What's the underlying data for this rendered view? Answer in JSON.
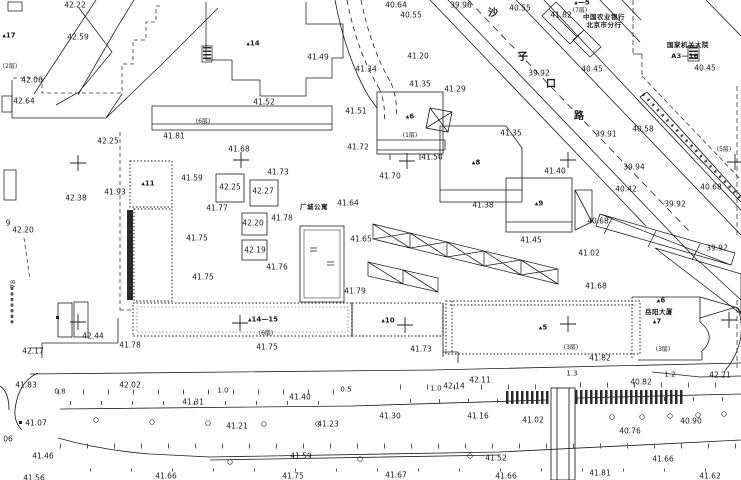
{
  "map_meta": {
    "type": "cadastral-site-plan",
    "background_color": "#ffffff",
    "line_color": "#1c1c1c",
    "dashed_color": "#444444"
  },
  "annotations": [
    {
      "x": 75,
      "y": 5,
      "t": "42.22",
      "k": "e"
    },
    {
      "x": 78,
      "y": 37,
      "t": "42.59",
      "k": "e"
    },
    {
      "x": 32,
      "y": 80,
      "t": "42.06",
      "k": "e"
    },
    {
      "x": 24,
      "y": 101,
      "t": "42.64",
      "k": "e"
    },
    {
      "x": 76,
      "y": 198,
      "t": "42.38",
      "k": "e"
    },
    {
      "x": 23,
      "y": 230,
      "t": "42.20",
      "k": "e"
    },
    {
      "x": 8,
      "y": 223,
      "t": "9",
      "k": "e"
    },
    {
      "x": 108,
      "y": 141,
      "t": "42.25",
      "k": "e"
    },
    {
      "x": 115,
      "y": 192,
      "t": "41.93",
      "k": "e"
    },
    {
      "x": 192,
      "y": 178,
      "t": "41.59",
      "k": "e"
    },
    {
      "x": 217,
      "y": 208,
      "t": "41.77",
      "k": "e"
    },
    {
      "x": 197,
      "y": 238,
      "t": "41.75",
      "k": "e"
    },
    {
      "x": 203,
      "y": 277,
      "t": "41.75",
      "k": "e"
    },
    {
      "x": 174,
      "y": 136,
      "t": "41.81",
      "k": "e"
    },
    {
      "x": 239,
      "y": 149,
      "t": "41.68",
      "k": "e"
    },
    {
      "x": 278,
      "y": 172,
      "t": "41.73",
      "k": "e"
    },
    {
      "x": 230,
      "y": 187,
      "t": "42.25",
      "k": "e"
    },
    {
      "x": 263,
      "y": 191,
      "t": "42.27",
      "k": "e"
    },
    {
      "x": 253,
      "y": 223,
      "t": "42.20",
      "k": "e"
    },
    {
      "x": 282,
      "y": 218,
      "t": "41.78",
      "k": "e"
    },
    {
      "x": 255,
      "y": 250,
      "t": "42.19",
      "k": "e"
    },
    {
      "x": 277,
      "y": 267,
      "t": "41.76",
      "k": "e"
    },
    {
      "x": 348,
      "y": 203,
      "t": "41.64",
      "k": "e"
    },
    {
      "x": 355,
      "y": 291,
      "t": "41.79",
      "k": "e"
    },
    {
      "x": 361,
      "y": 239,
      "t": "41.65",
      "k": "e"
    },
    {
      "x": 390,
      "y": 176,
      "t": "41.70",
      "k": "e"
    },
    {
      "x": 356,
      "y": 111,
      "t": "41.51",
      "k": "e"
    },
    {
      "x": 264,
      "y": 102,
      "t": "41.52",
      "k": "e"
    },
    {
      "x": 318,
      "y": 57,
      "t": "41.49",
      "k": "e"
    },
    {
      "x": 366,
      "y": 69,
      "t": "41.34",
      "k": "e"
    },
    {
      "x": 358,
      "y": 147,
      "t": "41.72",
      "k": "e"
    },
    {
      "x": 418,
      "y": 56,
      "t": "41.20",
      "k": "e"
    },
    {
      "x": 420,
      "y": 84,
      "t": "41.35",
      "k": "e"
    },
    {
      "x": 455,
      "y": 89,
      "t": "41.29",
      "k": "e"
    },
    {
      "x": 432,
      "y": 157,
      "t": "41.50",
      "k": "e"
    },
    {
      "x": 483,
      "y": 205,
      "t": "41.38",
      "k": "e"
    },
    {
      "x": 396,
      "y": 5,
      "t": "40.64",
      "k": "e"
    },
    {
      "x": 411,
      "y": 15,
      "t": "40.55",
      "k": "e"
    },
    {
      "x": 461,
      "y": 5,
      "t": "39.96",
      "k": "e"
    },
    {
      "x": 520,
      "y": 8,
      "t": "40.55",
      "k": "e"
    },
    {
      "x": 561,
      "y": 15,
      "t": "41.82",
      "k": "e"
    },
    {
      "x": 539,
      "y": 73,
      "t": "39.92",
      "k": "e"
    },
    {
      "x": 592,
      "y": 69,
      "t": "40.45",
      "k": "e"
    },
    {
      "x": 705,
      "y": 68,
      "t": "40.45",
      "k": "e"
    },
    {
      "x": 643,
      "y": 129,
      "t": "40.58",
      "k": "e"
    },
    {
      "x": 606,
      "y": 134,
      "t": "39.91",
      "k": "e"
    },
    {
      "x": 634,
      "y": 167,
      "t": "39.94",
      "k": "e"
    },
    {
      "x": 555,
      "y": 171,
      "t": "41.40",
      "k": "e"
    },
    {
      "x": 511,
      "y": 133,
      "t": "41.35",
      "k": "e"
    },
    {
      "x": 626,
      "y": 189,
      "t": "40.42",
      "k": "e"
    },
    {
      "x": 598,
      "y": 221,
      "t": "40.68",
      "k": "e"
    },
    {
      "x": 711,
      "y": 187,
      "t": "40.68",
      "k": "e"
    },
    {
      "x": 675,
      "y": 204,
      "t": "39.92",
      "k": "e"
    },
    {
      "x": 717,
      "y": 248,
      "t": "39.92",
      "k": "e"
    },
    {
      "x": 531,
      "y": 240,
      "t": "41.45",
      "k": "e"
    },
    {
      "x": 589,
      "y": 253,
      "t": "41.02",
      "k": "e"
    },
    {
      "x": 596,
      "y": 286,
      "t": "41.68",
      "k": "e"
    },
    {
      "x": 93,
      "y": 336,
      "t": "42.44",
      "k": "e"
    },
    {
      "x": 33,
      "y": 351,
      "t": "42.17",
      "k": "e"
    },
    {
      "x": 130,
      "y": 345,
      "t": "41.78",
      "k": "e"
    },
    {
      "x": 26,
      "y": 385,
      "t": "41.83",
      "k": "e"
    },
    {
      "x": 130,
      "y": 385,
      "t": "42.02",
      "k": "e"
    },
    {
      "x": 193,
      "y": 402,
      "t": "41.31",
      "k": "e"
    },
    {
      "x": 36,
      "y": 423,
      "t": "41.07",
      "k": "e"
    },
    {
      "x": 237,
      "y": 426,
      "t": "41.21",
      "k": "e"
    },
    {
      "x": 43,
      "y": 456,
      "t": "41.46",
      "k": "e"
    },
    {
      "x": 34,
      "y": 478,
      "t": "41.56",
      "k": "e"
    },
    {
      "x": 166,
      "y": 476,
      "t": "41.66",
      "k": "e"
    },
    {
      "x": 8,
      "y": 439,
      "t": "06",
      "k": "e"
    },
    {
      "x": 267,
      "y": 347,
      "t": "41.75",
      "k": "e"
    },
    {
      "x": 421,
      "y": 349,
      "t": "41.73",
      "k": "e"
    },
    {
      "x": 300,
      "y": 397,
      "t": "41.40",
      "k": "e"
    },
    {
      "x": 454,
      "y": 386,
      "t": "42.14",
      "k": "e"
    },
    {
      "x": 480,
      "y": 380,
      "t": "42.11",
      "k": "e"
    },
    {
      "x": 390,
      "y": 416,
      "t": "41.30",
      "k": "e"
    },
    {
      "x": 478,
      "y": 416,
      "t": "41.16",
      "k": "e"
    },
    {
      "x": 328,
      "y": 424,
      "t": "41.23",
      "k": "e"
    },
    {
      "x": 301,
      "y": 456,
      "t": "41.59",
      "k": "e"
    },
    {
      "x": 293,
      "y": 476,
      "t": "41.75",
      "k": "e"
    },
    {
      "x": 396,
      "y": 475,
      "t": "41.67",
      "k": "e"
    },
    {
      "x": 600,
      "y": 358,
      "t": "41.82",
      "k": "e"
    },
    {
      "x": 720,
      "y": 375,
      "t": "42.21",
      "k": "e"
    },
    {
      "x": 641,
      "y": 382,
      "t": "40.82",
      "k": "e"
    },
    {
      "x": 533,
      "y": 420,
      "t": "41.02",
      "k": "e"
    },
    {
      "x": 691,
      "y": 421,
      "t": "40.90",
      "k": "e"
    },
    {
      "x": 630,
      "y": 431,
      "t": "40.76",
      "k": "e"
    },
    {
      "x": 496,
      "y": 458,
      "t": "41.52",
      "k": "e"
    },
    {
      "x": 663,
      "y": 459,
      "t": "41.66",
      "k": "e"
    },
    {
      "x": 600,
      "y": 473,
      "t": "41.81",
      "k": "e"
    },
    {
      "x": 710,
      "y": 476,
      "t": "41.62",
      "k": "e"
    },
    {
      "x": 506,
      "y": 476,
      "t": "41.66",
      "k": "e"
    },
    {
      "x": 60,
      "y": 392,
      "t": "0.8",
      "k": "d"
    },
    {
      "x": 223,
      "y": 391,
      "t": "1.0",
      "k": "d"
    },
    {
      "x": 346,
      "y": 390,
      "t": "0.5",
      "k": "d"
    },
    {
      "x": 436,
      "y": 389,
      "t": "1.0",
      "k": "d"
    },
    {
      "x": 572,
      "y": 374,
      "t": "1.3",
      "k": "d"
    },
    {
      "x": 670,
      "y": 375,
      "t": "1.2",
      "k": "d"
    },
    {
      "x": 9,
      "y": 36,
      "t": "▴17",
      "k": "b"
    },
    {
      "x": 148,
      "y": 184,
      "t": "▴11",
      "k": "b"
    },
    {
      "x": 253,
      "y": 44,
      "t": "▴14",
      "k": "b"
    },
    {
      "x": 263,
      "y": 320,
      "t": "▴14—15",
      "k": "b"
    },
    {
      "x": 388,
      "y": 321,
      "t": "▴10",
      "k": "b"
    },
    {
      "x": 410,
      "y": 117,
      "t": "▴6",
      "k": "b"
    },
    {
      "x": 476,
      "y": 163,
      "t": "▴8",
      "k": "b"
    },
    {
      "x": 539,
      "y": 204,
      "t": "▴9",
      "k": "b"
    },
    {
      "x": 543,
      "y": 328,
      "t": "▴5",
      "k": "b"
    },
    {
      "x": 657,
      "y": 322,
      "t": "▴7",
      "k": "b"
    },
    {
      "x": 661,
      "y": 301,
      "t": "▴6",
      "k": "b"
    },
    {
      "x": 582,
      "y": 3,
      "t": "▴—5",
      "k": "b"
    },
    {
      "x": 10,
      "y": 67,
      "t": "(2层)",
      "k": "f"
    },
    {
      "x": 203,
      "y": 122,
      "t": "(6层)",
      "k": "f"
    },
    {
      "x": 266,
      "y": 334,
      "t": "(6层)",
      "k": "f"
    },
    {
      "x": 410,
      "y": 136,
      "t": "(1层)",
      "k": "f"
    },
    {
      "x": 571,
      "y": 348,
      "t": "(3层)",
      "k": "f"
    },
    {
      "x": 663,
      "y": 350,
      "t": "(3层)",
      "k": "f"
    },
    {
      "x": 580,
      "y": 11,
      "t": "(7层)",
      "k": "f"
    },
    {
      "x": 724,
      "y": 150,
      "t": "(5层)",
      "k": "f"
    },
    {
      "x": 314,
      "y": 207,
      "t": "厂城公寓",
      "k": "n"
    },
    {
      "x": 659,
      "y": 312,
      "t": "岳阳大厦",
      "k": "n"
    },
    {
      "x": 604,
      "y": 17,
      "t": "中国农业银行",
      "k": "n"
    },
    {
      "x": 604,
      "y": 25,
      "t": "北京市分行",
      "k": "n"
    },
    {
      "x": 688,
      "y": 45,
      "t": "国家机关大院",
      "k": "n"
    },
    {
      "x": 685,
      "y": 56,
      "t": "A3—16",
      "k": "n"
    },
    {
      "x": 493,
      "y": 14,
      "t": "沙",
      "k": "s"
    },
    {
      "x": 523,
      "y": 58,
      "t": "子",
      "k": "s"
    },
    {
      "x": 551,
      "y": 85,
      "t": "口",
      "k": "s"
    },
    {
      "x": 579,
      "y": 117,
      "t": "路",
      "k": "s"
    },
    {
      "x": 13,
      "y": 284,
      "t": "78",
      "k": "r"
    }
  ]
}
